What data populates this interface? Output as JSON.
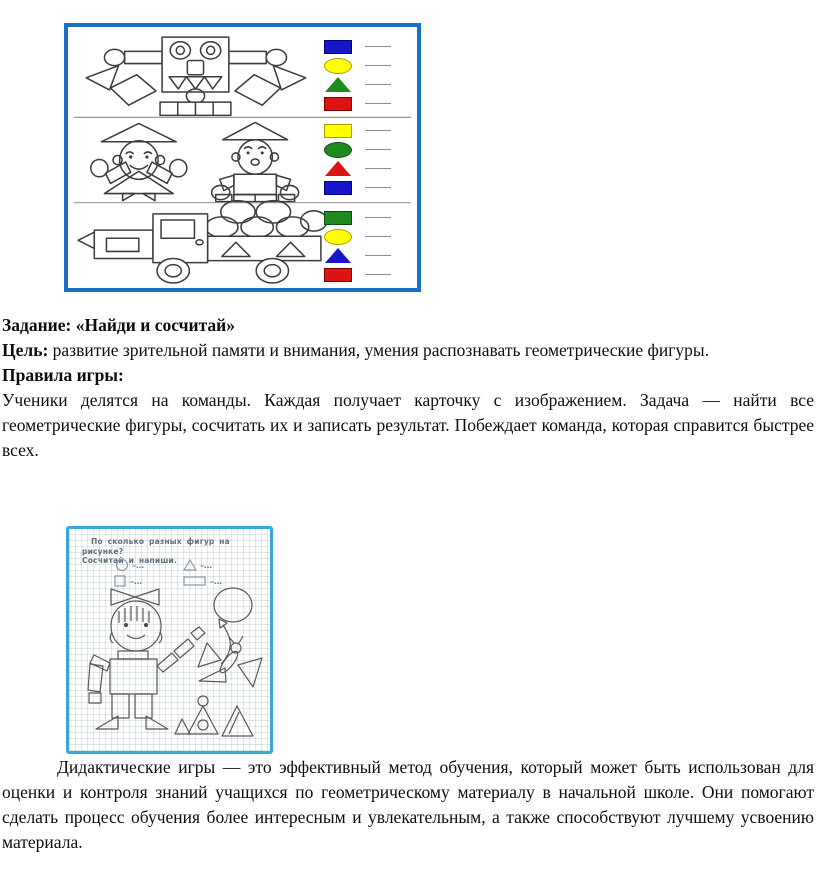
{
  "document": {
    "task_line": "Задание: «Найди и сосчитай»",
    "goal_label": "Цель:",
    "goal_text": "развитие зрительной памяти и внимания, умения распознавать геометрические фигуры.",
    "rules_label": "Правила игры:",
    "rules_text": "Ученики делятся на команды. Каждая получает карточку с изображением. Задача — найти все геометрические фигуры, сосчитать их и записать результат. Побеждает команда, которая справится быстрее всех.",
    "conclusion_text": "Дидактические игры — это эффективный метод обучения, который может быть использован для оценки и контроля знаний учащихся по геометрическому материалу в начальной школе. Они помогают сделать процесс обучения более интересным и увлекательным, а также способствуют лучшему усвоению материала."
  },
  "worksheet1": {
    "border_color": "#1a6fc8",
    "rows": [
      "robot",
      "children",
      "truck"
    ],
    "legend": [
      {
        "row": "robot",
        "top": 10,
        "items": [
          {
            "shape": "rect",
            "color": "#1717c9",
            "border": "#000080"
          },
          {
            "shape": "ellipse",
            "color": "#ffff00",
            "border": "#b09a00"
          },
          {
            "shape": "triangle",
            "color": "#1f8b1f"
          },
          {
            "shape": "rect",
            "color": "#dd1414",
            "border": "#7a0000"
          }
        ]
      },
      {
        "row": "children",
        "top": 94,
        "items": [
          {
            "shape": "rect",
            "color": "#ffff00",
            "border": "#b09a00"
          },
          {
            "shape": "ellipse",
            "color": "#1f8b1f",
            "border": "#0f4d0f"
          },
          {
            "shape": "triangle",
            "color": "#dd1414"
          },
          {
            "shape": "rect",
            "color": "#1717c9",
            "border": "#000080"
          }
        ]
      },
      {
        "row": "truck",
        "top": 181,
        "items": [
          {
            "shape": "rect",
            "color": "#1f8b1f",
            "border": "#0f4d0f"
          },
          {
            "shape": "ellipse",
            "color": "#ffff00",
            "border": "#b09a00"
          },
          {
            "shape": "triangle",
            "color": "#1717c9"
          },
          {
            "shape": "rect",
            "color": "#dd1414",
            "border": "#7a0000"
          }
        ]
      }
    ]
  },
  "worksheet2": {
    "border_color": "#35a8e0",
    "title_line1": "По сколько разных фигур на рисунке?",
    "title_line2": "Сосчитай и напиши.",
    "count_items": [
      {
        "shape": "circle",
        "label": "–…"
      },
      {
        "shape": "triangle",
        "label": "–…"
      },
      {
        "shape": "square",
        "label": "–…"
      },
      {
        "shape": "rectangle",
        "label": "–…"
      }
    ],
    "watermark": "····················"
  }
}
